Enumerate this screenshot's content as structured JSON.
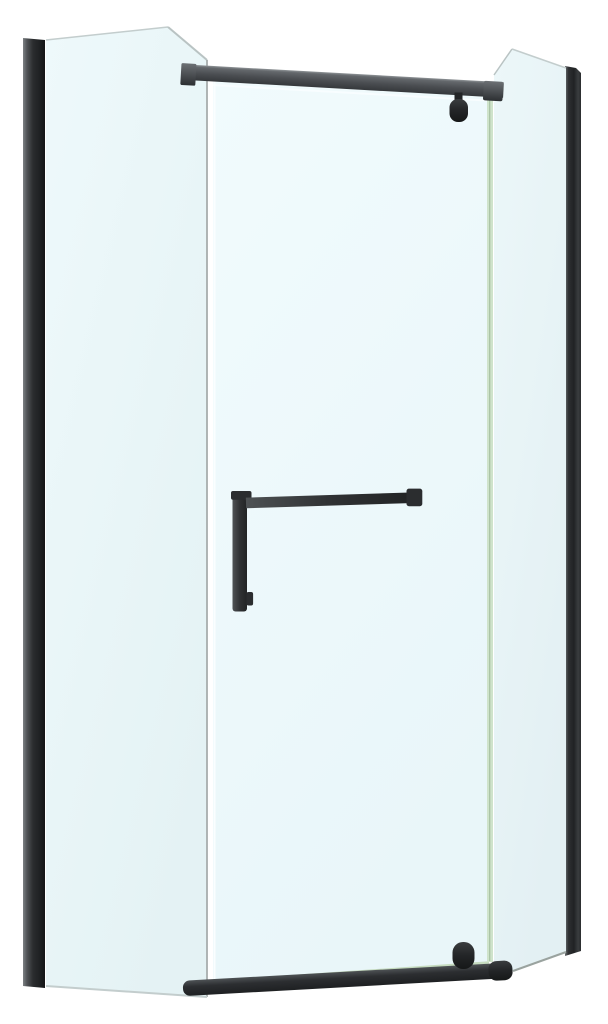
{
  "page": {
    "background": "#ffffff",
    "description": "Product photo of a neo-angle corner shower enclosure with matte black aluminum profiles, top and bottom support bars, a pivot door with black towel-bar handle, and light blue tinted glass panels on a plain white background"
  },
  "colors": {
    "background": "#ffffff",
    "profile_left": {
      "s0": "#7d8184",
      "s1": "#515457",
      "s2": "#2b2d2f",
      "s3": "#1d1f21",
      "s4": "#141516"
    },
    "profile_right": {
      "s0": "#6a6e71",
      "s1": "#2e3032",
      "s2": "#202224",
      "s3": "#3a3d3f",
      "s4": "#2a2c2e"
    },
    "glass_left": {
      "top": "#eef9fb",
      "bottom": "#e4f2f4"
    },
    "glass_door": {
      "top": "#f1fbfd",
      "bottom": "#e9f6f9"
    },
    "glass_right": {
      "top": "#ecf7f9",
      "bottom": "#e3f0f3"
    },
    "top_bar": {
      "s0": "#8f9497",
      "s1": "#64686c",
      "s2": "#4a4d51",
      "s3": "#35383b"
    },
    "bottom_bar": {
      "s0": "#4e5255",
      "s1": "#2c2e31",
      "s2": "#1e2022"
    },
    "hardware": {
      "s0": "#3a3d3f",
      "s1": "#232527",
      "s2": "#161818"
    },
    "handle": {
      "s0": "#4e5254",
      "s1": "#303234",
      "s2": "#222425"
    },
    "caps": {
      "light": "#6c7074",
      "dark": "#2c2f32",
      "flat": "#2b2d2f"
    },
    "edges": {
      "glass_gray": "#a7adad",
      "glass_soft": "#c3cdcd",
      "chamfer": "#b9c3c3",
      "green": "#cfe3cb",
      "green_dark": "#a6c0a2",
      "bottom_green": "#c6dcc0",
      "panel_bottom": "#9aa39f",
      "white_highlight": "#fafeff"
    }
  }
}
